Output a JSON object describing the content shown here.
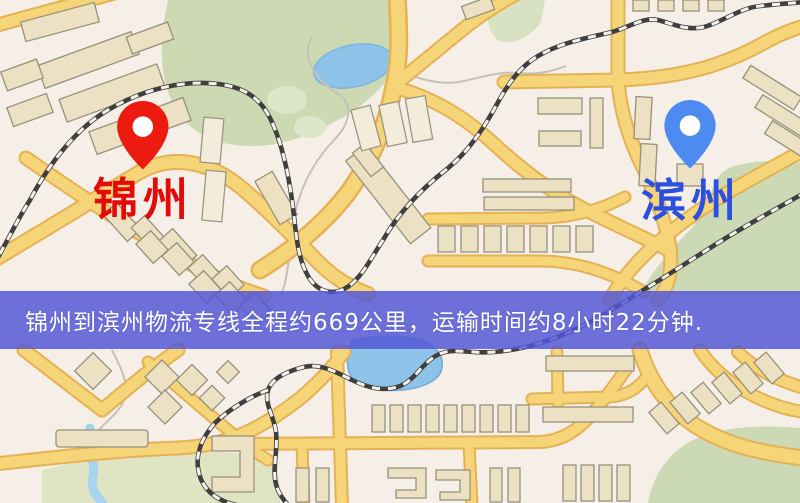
{
  "route_banner": {
    "text": "锦州到滨州物流专线全程约669公里，运输时间约8小时22分钟.",
    "origin": "锦州",
    "destination": "滨州",
    "distance_text": "约669公里",
    "duration_text": "约8小时22分钟",
    "background_color": "#5257d7",
    "text_color": "#ffffff"
  },
  "map": {
    "origin_marker": {
      "label": "锦州",
      "pin_color": "#ed1a10",
      "label_color": "#e30b07"
    },
    "destination_marker": {
      "label": "滨州",
      "pin_color": "#4d8bf0",
      "label_color": "#2d4fe0"
    },
    "palette": {
      "background": "#f6efe7",
      "road_fill": "#f6d579",
      "road_border": "#e4b254",
      "building_fill": "#ece1c3",
      "building_stroke": "#97917d",
      "park_green": "#ccd9b3",
      "water_blue": "#8ec3e9",
      "railway_dark": "#3f3f3f"
    }
  }
}
